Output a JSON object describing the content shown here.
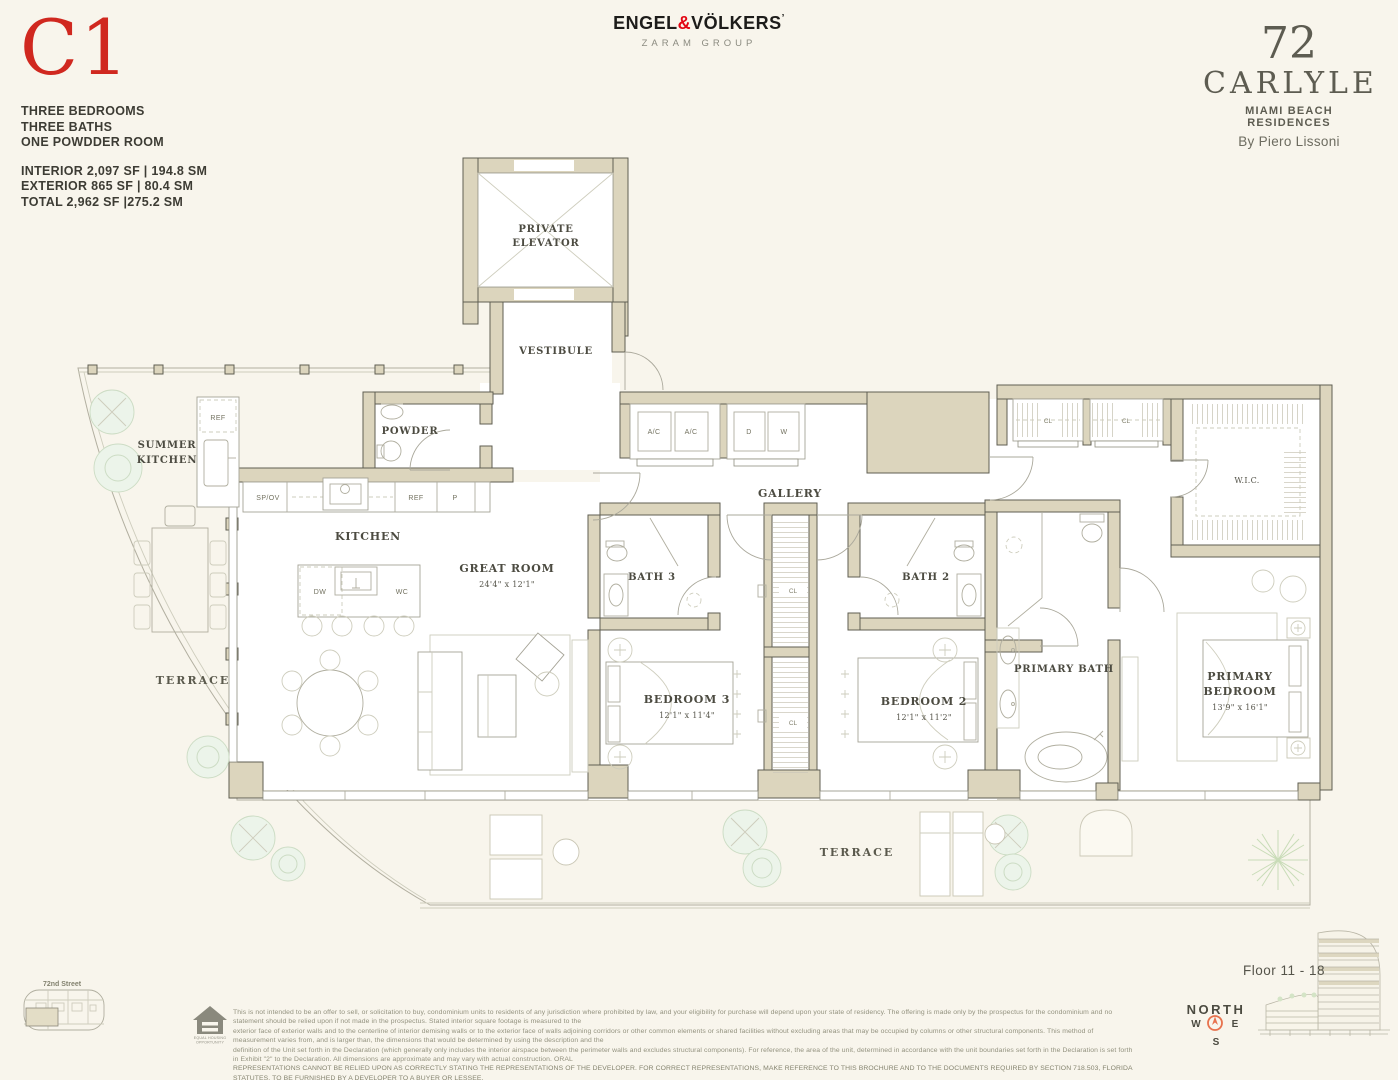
{
  "header": {
    "unit_code": "C1",
    "features": [
      "THREE BEDROOMS",
      "THREE BATHS",
      "ONE POWDDER ROOM"
    ],
    "areas": [
      "INTERIOR 2,097 SF | 194.8 SM",
      "EXTERIOR  865 SF | 80.4 SM",
      "TOTAL 2,962 SF |275.2 SM"
    ]
  },
  "brokerage": {
    "engel": "ENGEL",
    "amp": "&",
    "volkers": "VÖLKERS",
    "mark": "’",
    "group": "ZARAM GROUP"
  },
  "building_brand": {
    "number": "72",
    "name": "CARLYLE",
    "sub": "MIAMI BEACH RESIDENCES",
    "byline": "By Piero Lissoni"
  },
  "plan": {
    "rooms": {
      "private_elevator_line1": "PRIVATE",
      "private_elevator_line2": "ELEVATOR",
      "vestibule": "VESTIBULE",
      "powder": "POWDER",
      "summer_kitchen_line1": "SUMMER",
      "summer_kitchen_line2": "KITCHEN",
      "kitchen": "KITCHEN",
      "great_room": "GREAT ROOM",
      "great_room_dims": "24'4\" x 12'1\"",
      "gallery": "GALLERY",
      "bath3": "BATH 3",
      "bath2": "BATH 2",
      "wic": "W.I.C.",
      "bedroom3": "BEDROOM 3",
      "bedroom3_dims": "12'1\" x 11'4\"",
      "bedroom2": "BEDROOM 2",
      "bedroom2_dims": "12'1\" x 11'2\"",
      "primary_bath": "PRIMARY BATH",
      "primary_bedroom_line1": "PRIMARY",
      "primary_bedroom_line2": "BEDROOM",
      "primary_bedroom_dims": "13'9\" x 16'1\"",
      "terrace_left": "TERRACE",
      "terrace_bottom": "TERRACE"
    },
    "fixtures": {
      "summer_ref": "REF",
      "spov": "SP/OV",
      "ref": "REF",
      "pantry": "P",
      "dw": "DW",
      "wc": "WC",
      "ac1": "A/C",
      "ac2": "A/C",
      "dryer": "D",
      "washer": "W",
      "cl_top1": "CL",
      "cl_top2": "CL",
      "cl_mid1": "CL",
      "cl_mid2": "CL"
    },
    "keyplan_street": "72nd Street"
  },
  "footer": {
    "disclaimer_lines": [
      "This is not intended to be an offer to sell, or solicitation to buy, condominium units to residents of any jurisdiction where prohibited by law, and your eligibility for purchase will depend upon your state of residency. The offering is made only by the prospectus for the condominium and no statement should be relied upon if not made in the prospectus. Stated interior square footage is measured to the",
      "exterior face of exterior walls and to the centerline of interior demising walls or to the exterior face of walls adjoining corridors or other common elements or shared facilities without excluding areas that may be occupied by columns or other structural components. This method of measurement varies from, and is larger than, the dimensions that would be determined by using the description and the",
      "definition of the Unit set forth in the Declaration (which generally only includes the interior airspace between the perimeter walls and excludes structural components). For reference, the area of the unit, determined in accordance with the unit boundaries set forth in the Declaration is set forth in Exhibit \"2\" to the Declaration. All dimensions are approximate and may vary with actual construction. ORAL",
      "REPRESENTATIONS CANNOT BE RELIED UPON AS CORRECTLY STATING THE REPRESENTATIONS OF THE DEVELOPER.  FOR CORRECT REPRESENTATIONS, MAKE REFERENCE TO THIS BROCHURE AND TO THE DOCUMENTS REQUIRED BY SECTION 718.503, FLORIDA STATUTES, TO BE FURNISHED BY A DEVELOPER TO A BUYER OR LESSEE."
    ],
    "floor_range": "Floor 11 - 18",
    "compass": {
      "north": "NORTH",
      "west": "W",
      "east": "E",
      "south": "S"
    },
    "equal_housing_line1": "EQUAL HOUSING",
    "equal_housing_line2": "OPPORTUNITY"
  },
  "colors": {
    "accent_red": "#d0281f",
    "brand_red": "#e30613",
    "background": "#f8f5ec",
    "terrace_fill": "#ece8d7",
    "wall_fill": "#dcd5bd",
    "wall_line": "#5f5e52",
    "label_dark": "#4c4b41",
    "compass_orange": "#e8724d"
  }
}
